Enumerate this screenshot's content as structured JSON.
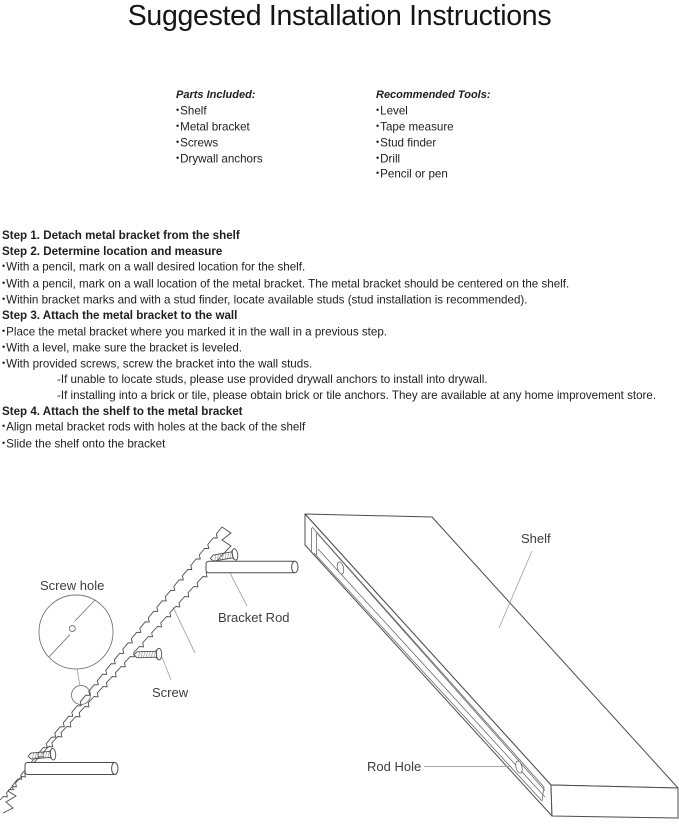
{
  "title": "Suggested Installation Instructions",
  "parts": {
    "heading": "Parts Included:",
    "items": [
      "Shelf",
      "Metal bracket",
      "Screws",
      "Drywall anchors"
    ]
  },
  "tools": {
    "heading": "Recommended Tools:",
    "items": [
      "Level",
      "Tape measure",
      "Stud finder",
      "Drill",
      "Pencil or pen"
    ]
  },
  "steps": [
    {
      "heading": "Step 1. Detach metal bracket from the shelf",
      "bullets": [],
      "subnotes": []
    },
    {
      "heading": "Step 2. Determine location and measure",
      "bullets": [
        "With a pencil, mark on a wall desired location for the shelf.",
        "With a pencil, mark on a wall location of the metal bracket. The metal bracket should be centered on the shelf.",
        "Within bracket marks and with a stud finder, locate available studs (stud installation is recommended)."
      ],
      "subnotes": []
    },
    {
      "heading": "Step 3. Attach the metal bracket to the wall",
      "bullets": [
        "Place the metal bracket where you marked it in the wall in a previous step.",
        "With a level, make sure the bracket is leveled.",
        "With provided screws, screw the bracket into the wall studs."
      ],
      "subnotes": [
        "-If unable to locate studs, please use provided drywall anchors to install into drywall.",
        "-If installing into a brick or tile, please obtain brick or tile anchors. They are available at any home improvement store."
      ]
    },
    {
      "heading": "Step 4. Attach the shelf to the metal bracket",
      "bullets": [
        "Align metal bracket rods with holes at the back of the shelf",
        "Slide the shelf onto the bracket"
      ],
      "subnotes": []
    }
  ],
  "diagram": {
    "labels": {
      "screw_hole": "Screw hole",
      "bracket_rod": "Bracket Rod",
      "screw": "Screw",
      "shelf": "Shelf",
      "rod_hole": "Rod Hole"
    }
  },
  "colors": {
    "text": "#1e1e1e",
    "diagram_line": "#4d4d4d",
    "leader_line": "#a8a8a8"
  }
}
